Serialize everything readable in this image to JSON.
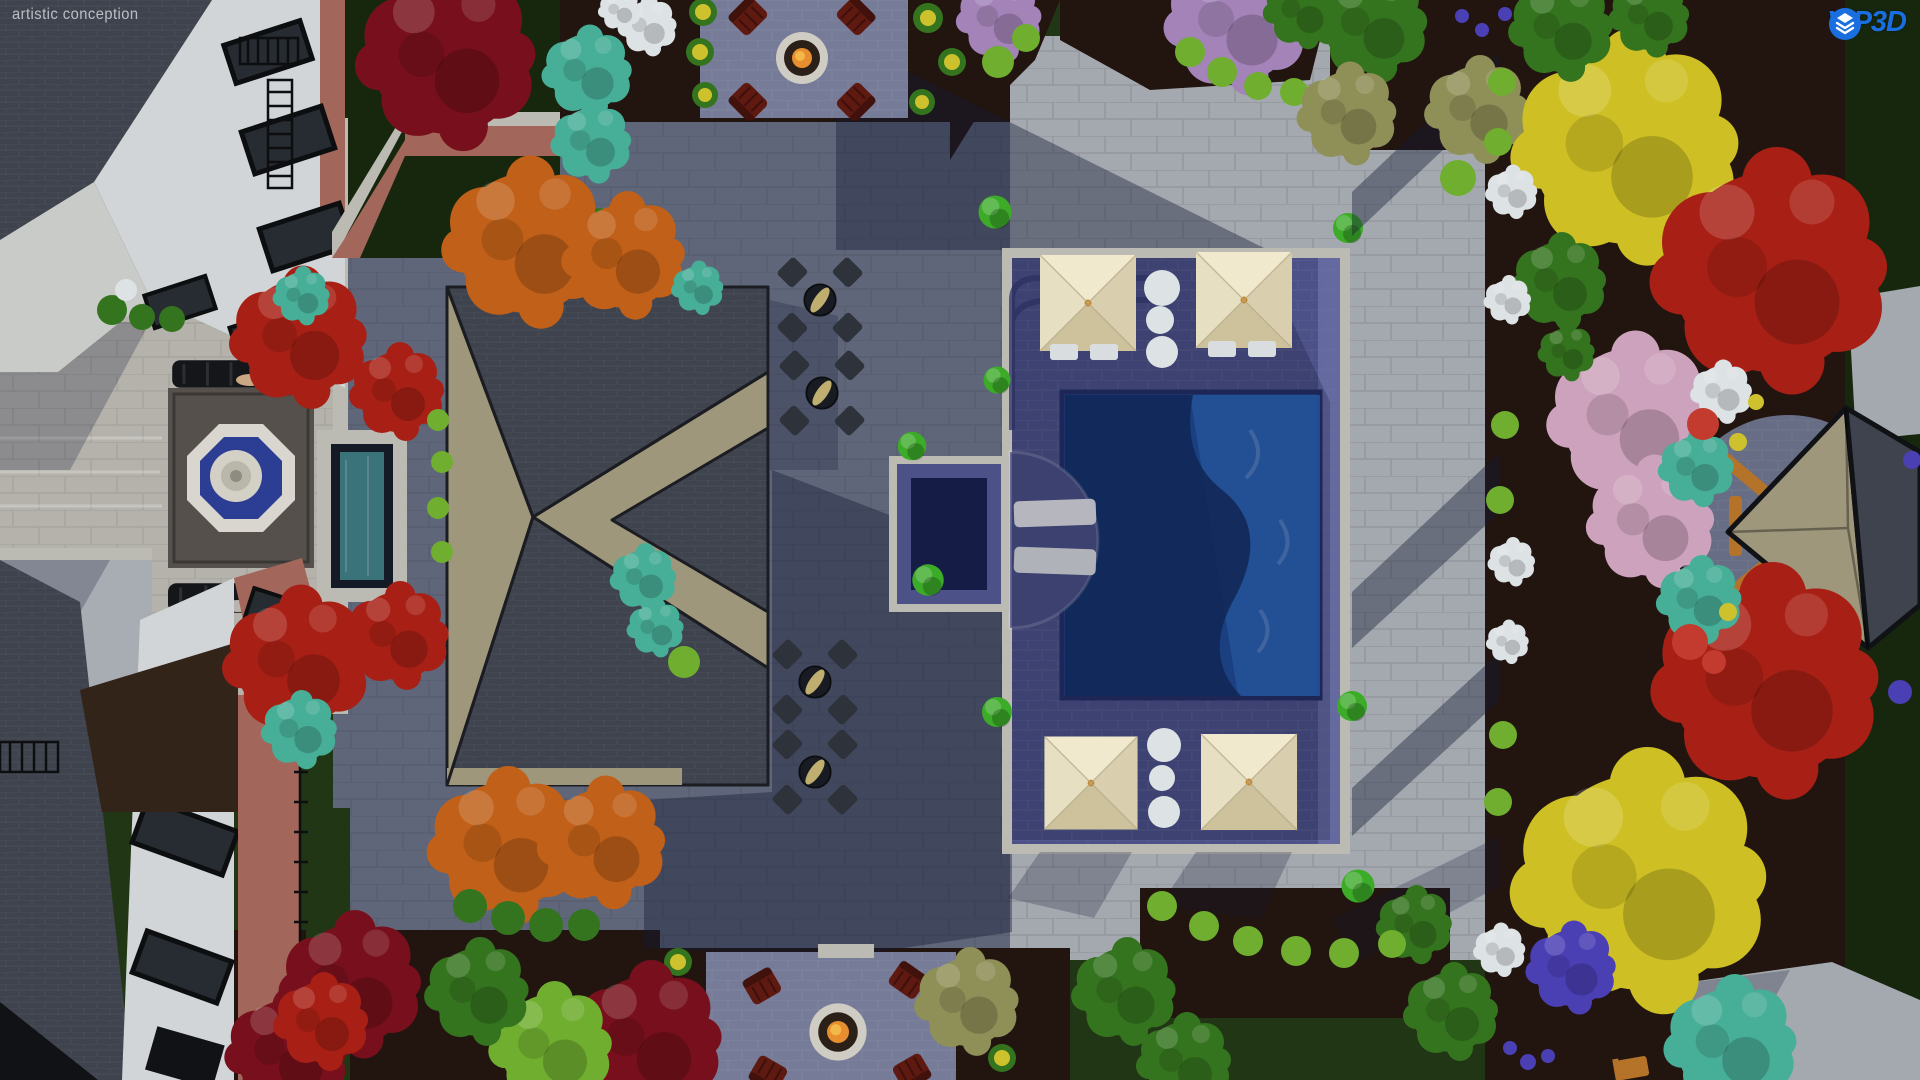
{
  "watermark": {
    "label": "artistic conception"
  },
  "logo": {
    "brand": "VIP3D",
    "icon": "stacked-3d-layers-icon",
    "color": "#1a6fe0"
  },
  "palette": {
    "logo_blue": "#1a6fe0",
    "watermark_gray": "#c9cdd3",
    "lawn": "#213614",
    "lawn_dark": "#17270e",
    "bed": "#221510",
    "dirt": "#33241a",
    "pav_lit": "#a4a9af",
    "pav_shade": "#5f6679",
    "pav_court": "#b4b2ab",
    "pav_pad": "#767b98",
    "deck": "#4c5187",
    "deck_lit": "#6f74a9",
    "coping": "#bcbbb3",
    "water": "#1d4e9b",
    "water_dark": "#122f63",
    "water_lit": "#2a66bb",
    "spa_water": "#151c46",
    "roof_lit": "#9f977b",
    "roof_dark": "#3e434d",
    "wall_white": "#d2d5d8",
    "brick": "#a2675a",
    "window_glass": "#262c31",
    "black_trim": "#101215",
    "wood": "#b5732a",
    "topiary": "#3cab28",
    "chair_red": "#5e1911",
    "red_tree": "#a82015",
    "crimson_tree": "#77101c",
    "orange_tree": "#c06019",
    "yellow_tree": "#cec024",
    "pink_tree": "#cda2bc",
    "green_tree": "#35741f",
    "lime_shrub": "#6fae2f",
    "teal_shrub": "#47ae97",
    "olive_shrub": "#8f8f58",
    "purple_tree": "#a383b8",
    "violet_flower": "#4b3fb4",
    "yellow_flower": "#cdc22e",
    "white_bloom": "#dde2e5",
    "red_flower": "#c23b2e",
    "cabana_cream": "#e9e2c6",
    "fire": "#e78f2e"
  },
  "scene": {
    "type": "3d-landscape-design-aerial-render",
    "features": [
      "main house",
      "courtyard fountain",
      "reflecting rill",
      "garden benches",
      "pavilion hip roof",
      "wood trellis panels",
      "bistro tables with umbrellas",
      "swimming pool",
      "spa",
      "tanning ledge loungers",
      "poolside cabanas",
      "white planter urns",
      "boxwood topiary balls",
      "fire pit with adirondack chairs",
      "garden gazebo",
      "paver patio",
      "mixed ornamental trees"
    ]
  }
}
